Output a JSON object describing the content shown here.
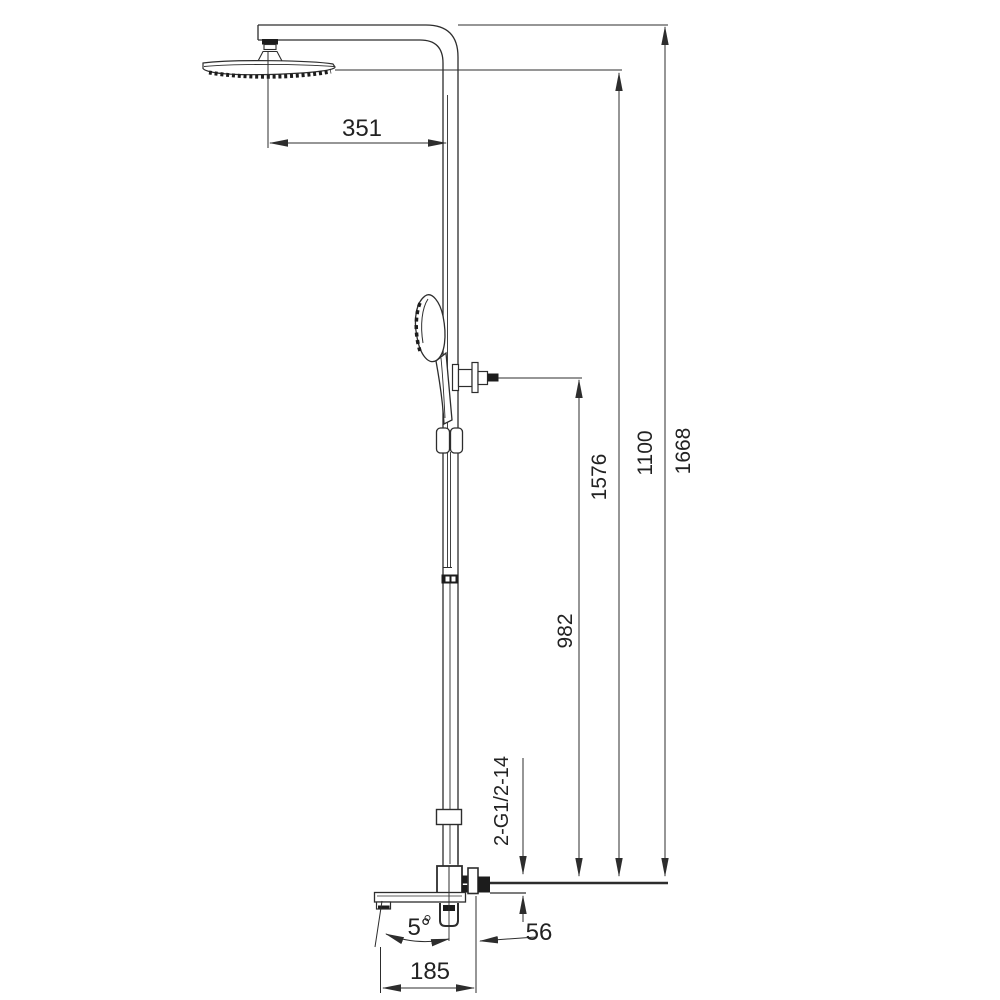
{
  "diagram": {
    "type": "technical-dimension-drawing",
    "subject": "shower column with rain head, hand shower and tub spout",
    "background": "#ffffff",
    "line_color": "#2d2d2d",
    "labels": {
      "arm_reach": "351",
      "handshower_outlet_height": "982",
      "showerhead_face_height": "1576",
      "riser_height": "1100",
      "overall_height": "1668",
      "thread_callout": "2-G1/2-14",
      "spout_angle": "5°",
      "outlet_offset": "56",
      "spout_reach": "185"
    }
  }
}
